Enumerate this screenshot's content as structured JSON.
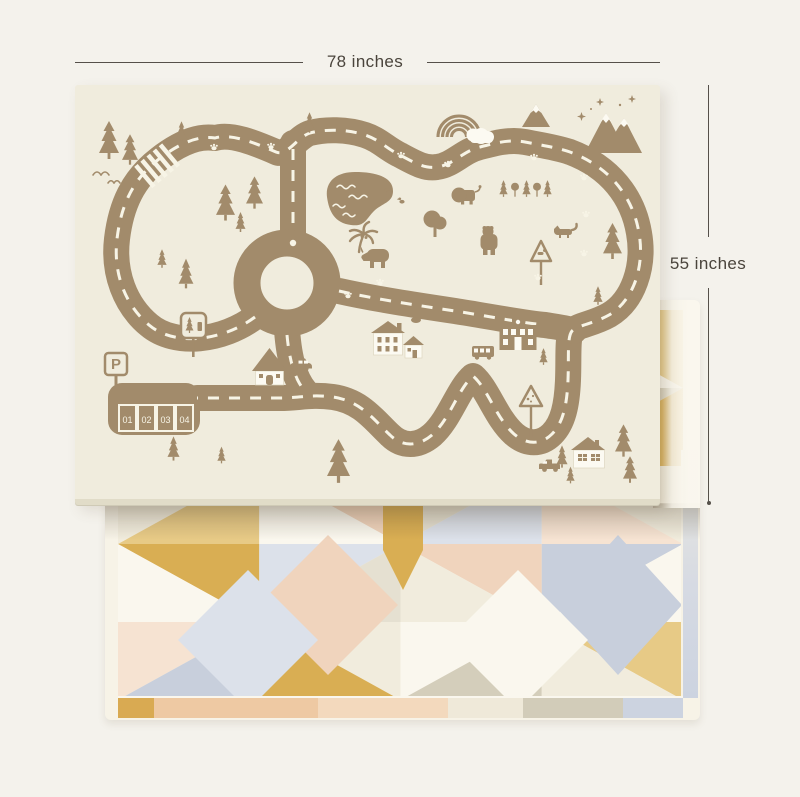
{
  "scene": {
    "background_color": "#f4f2ec",
    "description": "reversible kids play mat product photo, road map side on top, geometric pattern side behind"
  },
  "dimension_labels": {
    "width": "78 inches",
    "height": "55 inches",
    "line_color": "#55504a",
    "text_color": "#4a443c"
  },
  "road_mat": {
    "base_color": "#f0ecdd",
    "art_color": "#a28b6b",
    "marking_color": "#f7f4e6",
    "parking_sign": "P",
    "parking_slots": [
      "01",
      "02",
      "03",
      "04"
    ],
    "features": [
      "road-loop",
      "roundabout",
      "crosswalk",
      "parking-lot",
      "pond",
      "rainbow",
      "cloud",
      "mountains",
      "stars",
      "pine-trees",
      "lion",
      "bear",
      "rhinoceros",
      "fox",
      "ducks",
      "birds",
      "palm-tree",
      "houses",
      "cottage",
      "school",
      "bus",
      "car",
      "pickup-truck",
      "warning-signs",
      "paw-prints"
    ]
  },
  "pattern_mat": {
    "base_color": "#f7f3e7",
    "palette": {
      "gold": "#d9ae53",
      "lightGold": "#e7ca86",
      "blush": "#f0d4bd",
      "lightBlush": "#f6e3d2",
      "blueGray": "#c8cfdc",
      "paleBlue": "#dce1ea",
      "greige": "#d4cebb",
      "lightGreige": "#e5e0d1",
      "cream": "#f1ecdd",
      "offWhite": "#faf7ee"
    }
  }
}
